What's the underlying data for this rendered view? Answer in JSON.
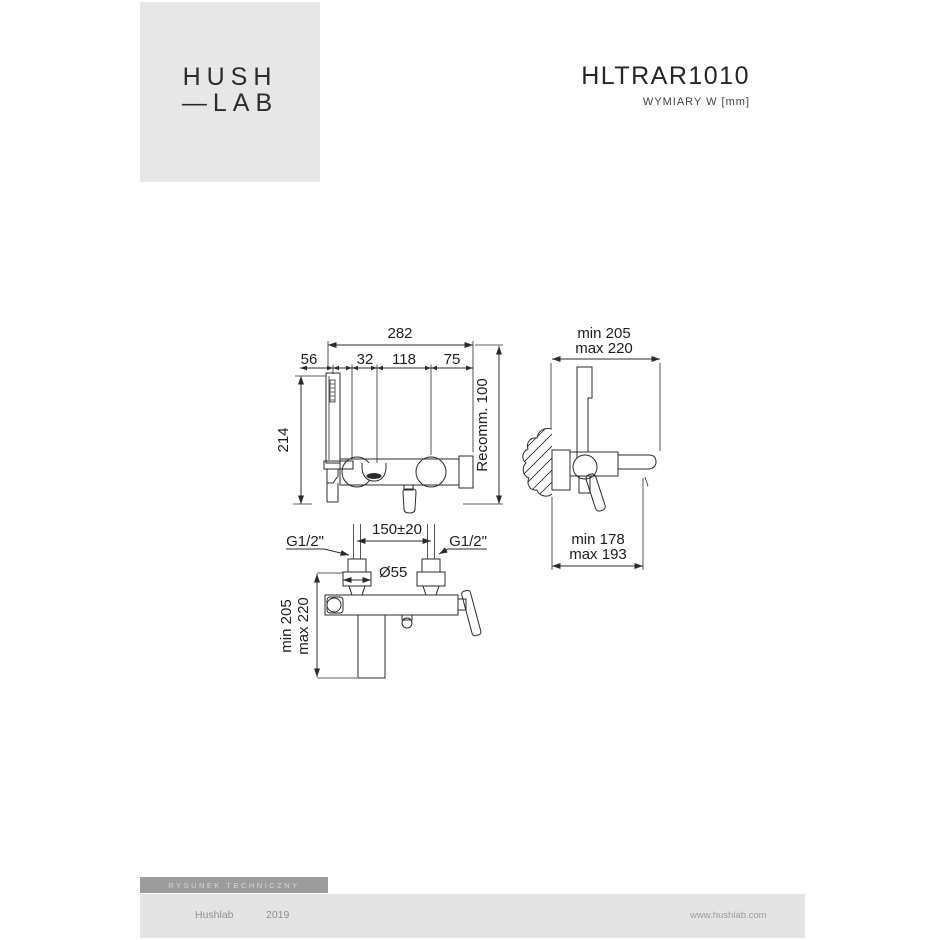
{
  "logo": {
    "line1": "HUSH",
    "line2": "—LAB"
  },
  "header": {
    "product_code": "HLTRAR1010",
    "units_note": "WYMIARY W [mm]"
  },
  "drawing": {
    "front_view": {
      "dim_total_width": "282",
      "dim_shower_offset": "56",
      "dim_spout_offset": "32",
      "dim_center_span": "118",
      "dim_right_span": "75",
      "dim_height": "214",
      "dim_recommended": "Recomm. 100"
    },
    "side_view": {
      "dim_top_min": "min 205",
      "dim_top_max": "max 220",
      "dim_bottom_min": "min 178",
      "dim_bottom_max": "max 193"
    },
    "top_view": {
      "dim_spacing": "150±20",
      "dim_thread_left": "G1/2\"",
      "dim_thread_right": "G1/2\"",
      "dim_diameter": "Ø55",
      "dim_depth_min": "min 205",
      "dim_depth_max": "max 220"
    }
  },
  "footer": {
    "label": "RYSUNEK TECHNICZNY",
    "brand": "Hushlab",
    "year": "2019",
    "website": "www.hushlab.com"
  }
}
